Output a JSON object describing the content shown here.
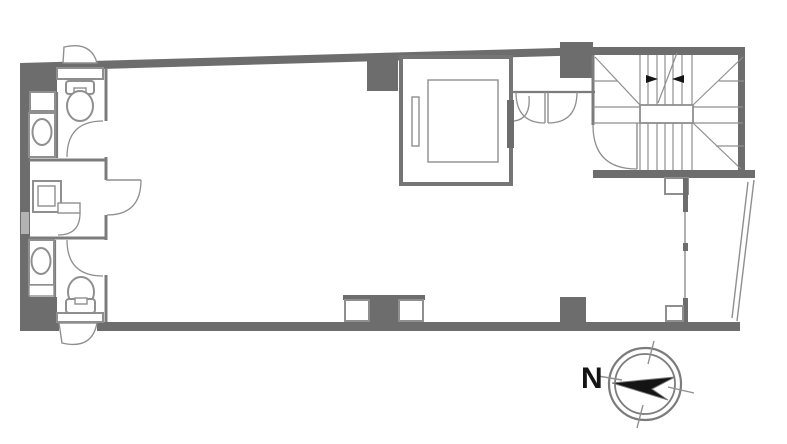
{
  "colors": {
    "wall": "#6d6d6d",
    "wall-medium": "#7c7c7c",
    "line": "#8f8f8f",
    "line-light": "#a9a9a9",
    "ink": "#141414",
    "bg": "#ffffff"
  },
  "compass": {
    "north_label": "N"
  }
}
